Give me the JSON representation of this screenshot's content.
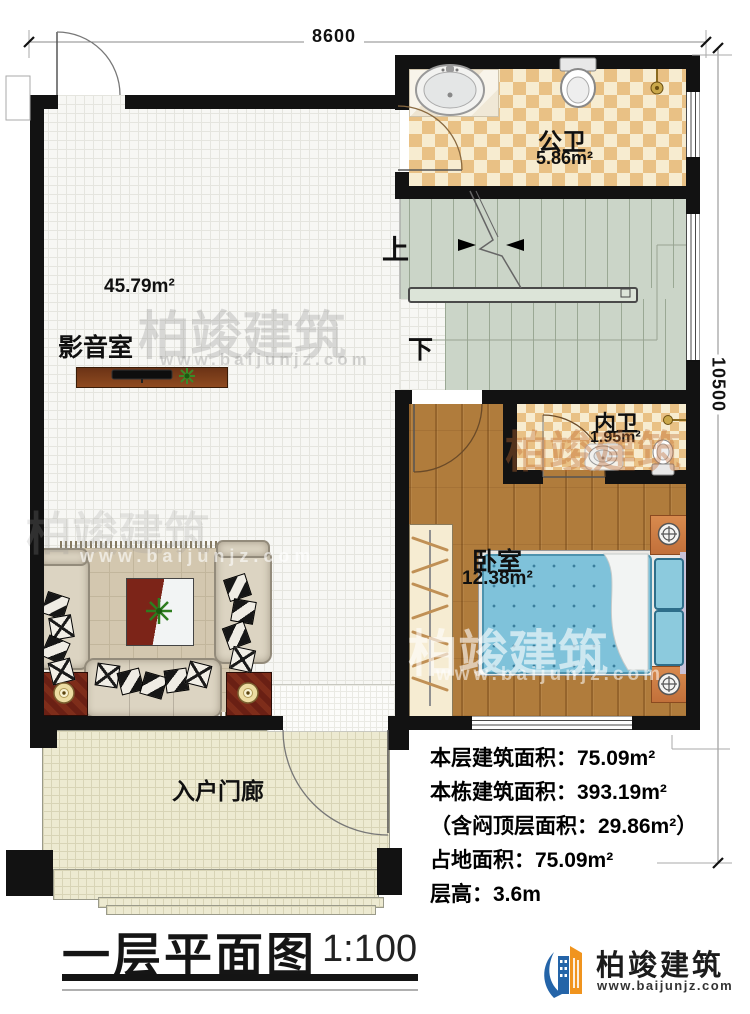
{
  "plan": {
    "dims": {
      "width_top": "8600",
      "height_right": "10500"
    },
    "rooms": {
      "media": {
        "name": "影音室",
        "area": "45.79m²"
      },
      "public_bath": {
        "name": "公卫",
        "area": "5.86m²"
      },
      "inner_bath": {
        "name": "内卫",
        "area": "1.95m²"
      },
      "bedroom": {
        "name": "卧室",
        "area": "12.38m²"
      },
      "porch": {
        "name": "入户门廊"
      }
    },
    "stairs": {
      "up_label": "上",
      "down_label": "下"
    }
  },
  "stats": {
    "lines": [
      "本层建筑面积：75.09m²",
      "本栋建筑面积：393.19m²",
      "（含闷顶层面积：29.86m²）",
      "占地面积：75.09m²",
      "层高：3.6m"
    ]
  },
  "title": {
    "text": "一层平面图",
    "scale": "1:100"
  },
  "brand": {
    "company": "柏竣建筑",
    "website": "www.baijunjz.com"
  },
  "watermark": {
    "text": "柏竣建筑",
    "website": "www.baijunjz.com"
  },
  "colors": {
    "wall": "#121212",
    "checker_tile": "#e9c185",
    "wood_floor": "#b07c3c",
    "stair": "#cbd5c8",
    "porch": "#edead1",
    "bed": "#7fc2da",
    "brand_blue": "#2464a8",
    "brand_orange": "#f0941e"
  }
}
